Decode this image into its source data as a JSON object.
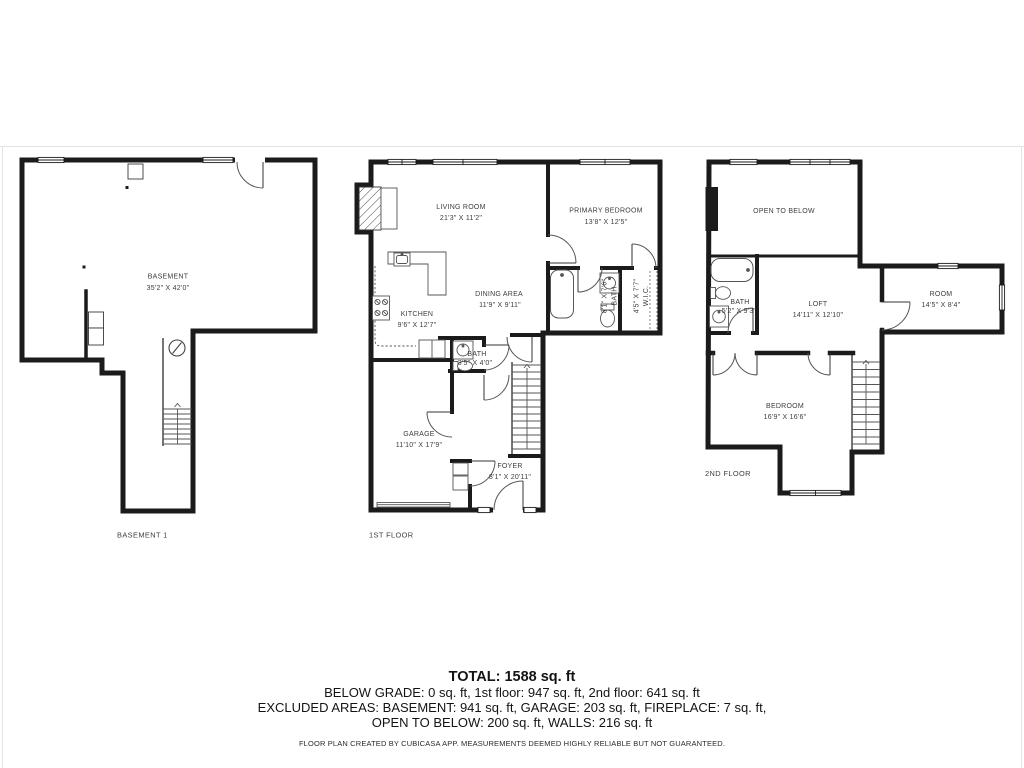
{
  "colors": {
    "wall": "#1b1b1b",
    "label": "#3d3d3d",
    "summary_text": "#141414",
    "frame_line": "#e3e3e3"
  },
  "basement": {
    "room": {
      "name": "BASEMENT",
      "dims": "35'2\" X 42'0\""
    },
    "floor_label": "BASEMENT 1"
  },
  "first": {
    "floor_label": "1ST FLOOR",
    "living": {
      "name": "LIVING ROOM",
      "dims": "21'3\" X 11'2\""
    },
    "primary": {
      "name": "PRIMARY BEDROOM",
      "dims": "13'8\" X 12'5\""
    },
    "dining": {
      "name": "DINING AREA",
      "dims": "11'9\" X 9'11\""
    },
    "kitchen": {
      "name": "KITCHEN",
      "dims": "9'6\" X 12'7\""
    },
    "bath_small": {
      "name": "BATH",
      "dims": "3'5\" X 4'0\""
    },
    "bath_primary": {
      "name": "BATH",
      "dims": "8'1\" X 7'6\""
    },
    "wic": {
      "name": "W.I.C.",
      "dims": "4'5\" X 7'7\""
    },
    "garage": {
      "name": "GARAGE",
      "dims": "11'10\" X 17'9\""
    },
    "foyer": {
      "name": "FOYER",
      "dims": "8'1\" X 20'11\""
    }
  },
  "second": {
    "floor_label": "2ND FLOOR",
    "open_to_below": {
      "name": "OPEN TO BELOW"
    },
    "loft": {
      "name": "LOFT",
      "dims": "14'11\" X 12'10\""
    },
    "room": {
      "name": "ROOM",
      "dims": "14'5\" X 8'4\""
    },
    "bath": {
      "name": "BATH",
      "dims": "5'2\" X 9'3\""
    },
    "bedroom": {
      "name": "BEDROOM",
      "dims": "16'9\" X 16'6\""
    }
  },
  "summary": {
    "total": "TOTAL: 1588 sq. ft",
    "line1": "BELOW GRADE: 0 sq. ft, 1st floor: 947 sq. ft, 2nd floor: 641 sq. ft",
    "line2": "EXCLUDED AREAS: BASEMENT: 941 sq. ft, GARAGE: 203 sq. ft, FIREPLACE: 7 sq. ft,",
    "line3": "OPEN TO BELOW: 200 sq. ft, WALLS: 216 sq. ft",
    "disclaimer": "FLOOR PLAN CREATED BY CUBICASA APP. MEASUREMENTS DEEMED HIGHLY RELIABLE BUT NOT GUARANTEED."
  }
}
